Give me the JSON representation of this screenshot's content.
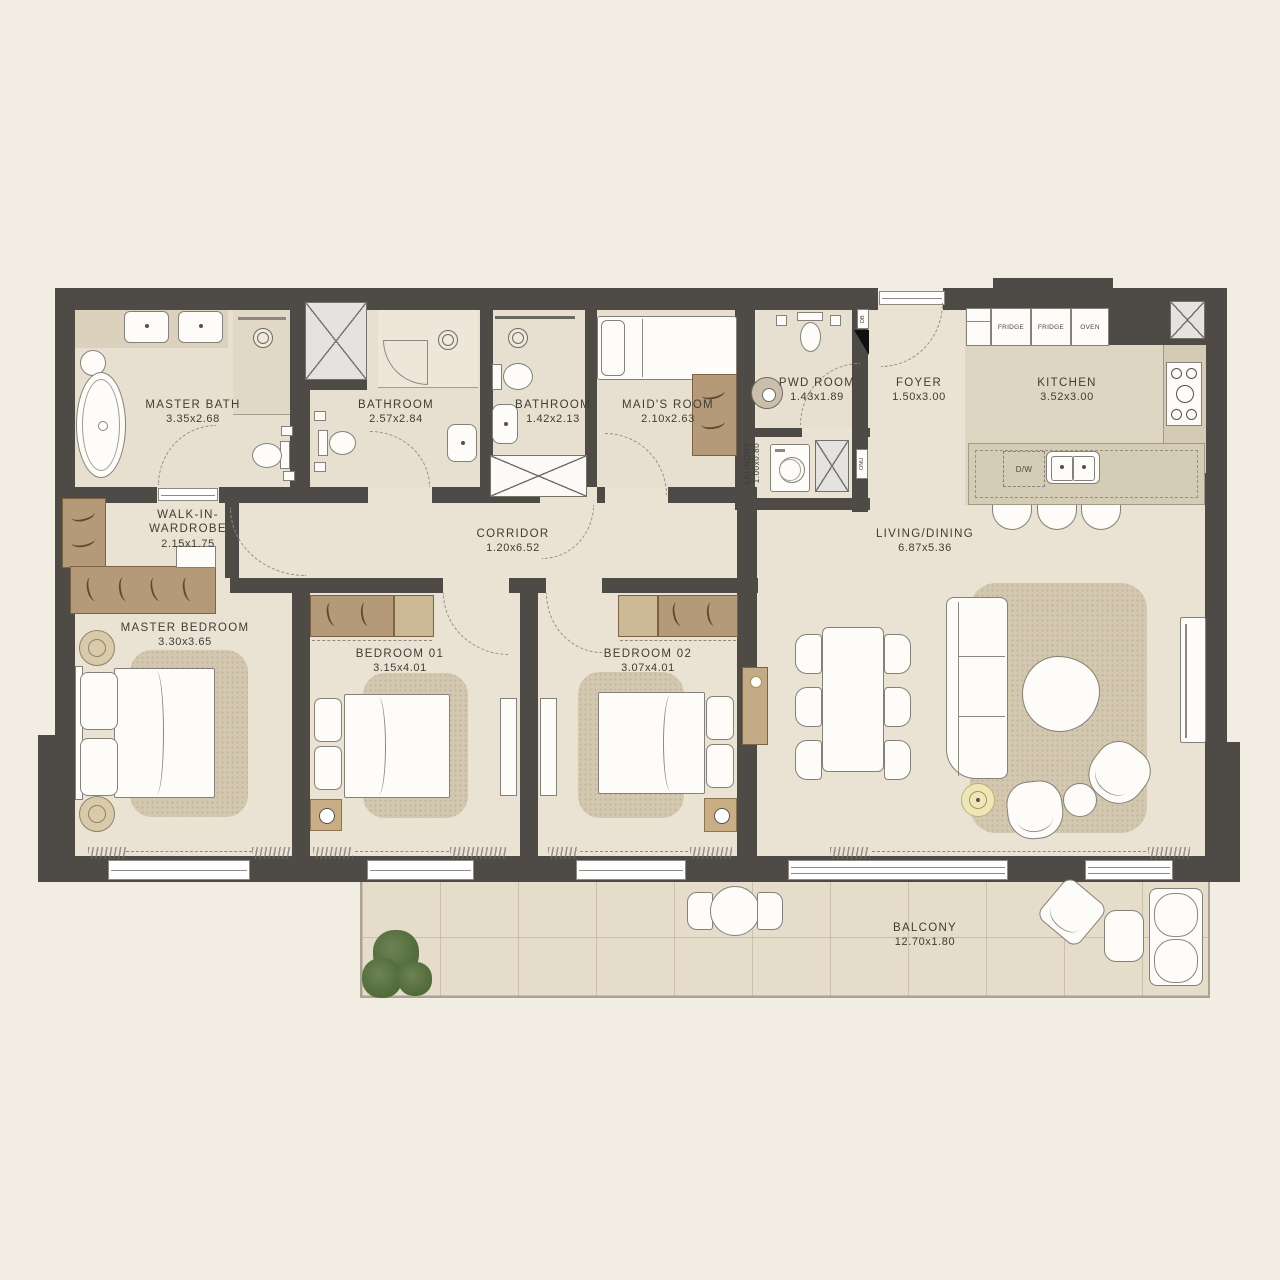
{
  "plan_title": "3 Bedroom Apartment Floor Plan",
  "colors": {
    "background": "#f2ede2",
    "wall": "#4e4b46",
    "floor": "#eae2d3",
    "wet_floor": "#e7dfcf",
    "kitchen_floor": "#ded5c2",
    "counter": "#d5ccb6",
    "balcony_floor": "#e5dcc9",
    "wood": "#b59a79",
    "rug": "#d3c8af",
    "plant_green": "#5c7748",
    "lamp_accent": "#efe6b7"
  },
  "rooms": [
    {
      "id": "master-bath",
      "name": "MASTER BATH",
      "dims": "3.35x2.68"
    },
    {
      "id": "bathroom-1",
      "name": "BATHROOM",
      "dims": "2.57x2.84"
    },
    {
      "id": "bathroom-2",
      "name": "BATHROOM",
      "dims": "1.42x2.13"
    },
    {
      "id": "maids-room",
      "name": "MAID'S ROOM",
      "dims": "2.10x2.63"
    },
    {
      "id": "pwd-room",
      "name": "PWD ROOM",
      "dims": "1.43x1.89"
    },
    {
      "id": "foyer",
      "name": "FOYER",
      "dims": "1.50x3.00"
    },
    {
      "id": "kitchen",
      "name": "KITCHEN",
      "dims": "3.52x3.00"
    },
    {
      "id": "laundry",
      "name": "LAUNDRY",
      "dims": "1.00x0.80"
    },
    {
      "id": "walk-in-wardrobe",
      "name": "WALK-IN-WARDROBE",
      "dims": "2.15x1.75"
    },
    {
      "id": "corridor",
      "name": "CORRIDOR",
      "dims": "1.20x6.52"
    },
    {
      "id": "living-dining",
      "name": "LIVING/DINING",
      "dims": "6.87x5.36"
    },
    {
      "id": "master-bedroom",
      "name": "MASTER BEDROOM",
      "dims": "3.30x3.65"
    },
    {
      "id": "bedroom-01",
      "name": "BEDROOM 01",
      "dims": "3.15x4.01"
    },
    {
      "id": "bedroom-02",
      "name": "BEDROOM 02",
      "dims": "3.07x4.01"
    },
    {
      "id": "balcony",
      "name": "BALCONY",
      "dims": "12.70x1.80"
    }
  ],
  "kitchen_labels": {
    "fridge_1": "FRIDGE",
    "fridge_2": "FRIDGE",
    "oven": "OVEN",
    "dishwasher": "D/W"
  },
  "utility_labels": {
    "db": "DB",
    "onu": "ONU"
  }
}
